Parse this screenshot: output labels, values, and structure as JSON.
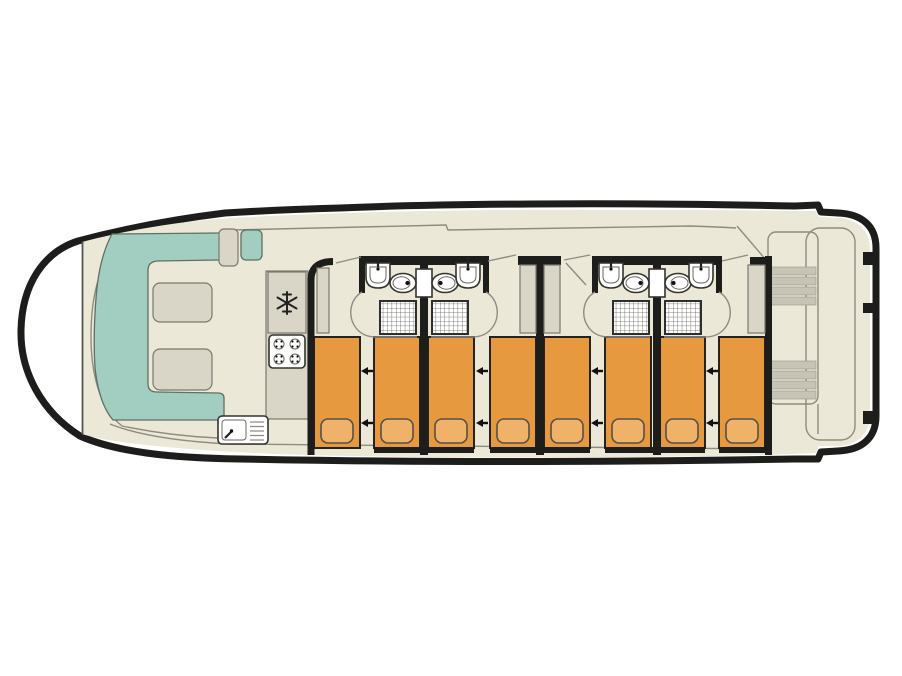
{
  "diagram": {
    "type": "boat-deck-floor-plan",
    "orientation": "bow-left-stern-right",
    "visible_text": [],
    "areas": {
      "bow_lounge": {
        "sofa": "u-shaped-teal-bench",
        "tables": 2,
        "side_seats": [
          "beige-seat",
          "teal-seat"
        ]
      },
      "galley": {
        "fridge_icon": "snowflake",
        "hob_burners": 4,
        "sink": "basin-with-drainer"
      },
      "cabins": 4,
      "beds_total": 8,
      "bathrooms_total": 4,
      "bathroom_fixtures": [
        "washbasin",
        "toilet",
        "shower"
      ],
      "wardrobes": 4,
      "stern_deck": {
        "staircases": 2,
        "steps_per_staircase": 4
      }
    }
  },
  "colors": {
    "background": "#ffffff",
    "hull_outline": "#1d1d1b",
    "deck": "#ebe8d7",
    "teal_seating": "#a2cec1",
    "furniture_grey": "#d9d6c8",
    "furniture_border": "#7b796d",
    "bed_orange": "#e79940",
    "pillow_orange": "#f0b269",
    "wall_black": "#1d1d1b",
    "thin_line": "#8e8c80",
    "fixture_white": "#ffffff",
    "fixture_border": "#333330",
    "stairs_grey": "#c7c4b6"
  },
  "layout": {
    "beds": {
      "xs": [
        314,
        374,
        428,
        490,
        544,
        605,
        659,
        719
      ],
      "y": 337,
      "w": 46,
      "h": 111,
      "pillow": {
        "dx": 7,
        "y": 419,
        "w": 32,
        "h": 24
      }
    },
    "slide_arrows": {
      "xs": [
        361,
        476,
        591,
        706
      ],
      "ys": [
        371,
        423
      ],
      "len": 12,
      "direction": "left"
    },
    "hull_windows_wall": {
      "y": 447,
      "h": 6,
      "segments": [
        [
          374,
          100
        ],
        [
          490,
          100
        ],
        [
          605,
          100
        ],
        [
          719,
          49
        ]
      ]
    },
    "wardrobes": [
      [
        317,
        268,
        12,
        65
      ],
      [
        520,
        265,
        16,
        68
      ],
      [
        544,
        265,
        16,
        68
      ],
      [
        748,
        265,
        17,
        68
      ]
    ],
    "stern_notches": {
      "x": 863,
      "w": 13,
      "items": [
        [
          252,
          13
        ],
        [
          303,
          10
        ],
        [
          411,
          13
        ]
      ]
    },
    "stairs": {
      "x": 770,
      "w": 46,
      "band_h": 8,
      "step_gap": 10,
      "flights": [
        [
          267,
          4
        ],
        [
          361,
          4
        ]
      ]
    },
    "bathroom_pairs_x": [
      0,
      233
    ]
  }
}
